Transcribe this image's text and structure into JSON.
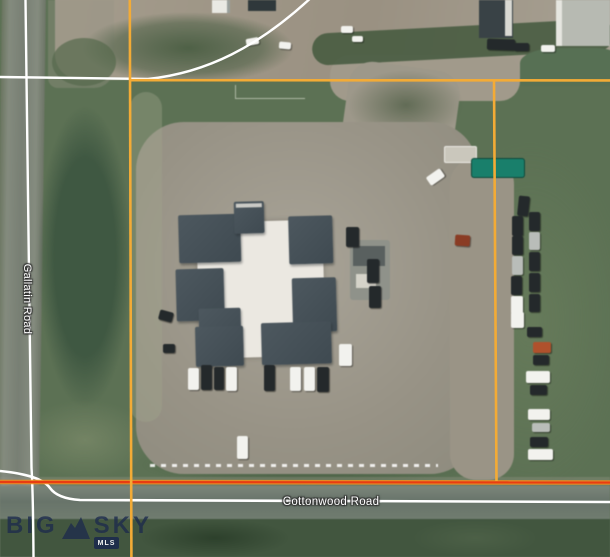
{
  "map_view": {
    "type": "satellite-aerial",
    "roads": {
      "gallatin_label": "Gallatin Road",
      "cottonwood_label": "Cottonwood Road"
    },
    "road_line_color": "#ffffff",
    "parcel_boundary": {
      "color_main": "#f3ab36",
      "color_section_line": "#e93c12",
      "color_section_glow": "#ef8c1e"
    },
    "watermark": {
      "brand_left": "BIG",
      "brand_right": "SKY",
      "badge": "MLS",
      "color": "#1d2b4d"
    },
    "terrain_colors": {
      "grass": "#5c7154",
      "grass_dark": "#41563e",
      "dirt": "#a39c8c",
      "parking": "#9b978b",
      "road": "#7e857d",
      "roof_dark": "#46525a",
      "roof_light": "#ebe8e1",
      "container_teal": "#15806b"
    },
    "vehicle_palette": {
      "dark": "#24292b",
      "white": "#f2f2ee",
      "silver": "#b9bdb9",
      "orange": "#b35029",
      "rust": "#8d3b22"
    },
    "vehicles": [
      [
        246,
        38,
        13,
        7,
        -10,
        "white"
      ],
      [
        279,
        42,
        12,
        7,
        5,
        "white"
      ],
      [
        341,
        26,
        12,
        7,
        0,
        "white"
      ],
      [
        352,
        36,
        11,
        6,
        0,
        "white"
      ],
      [
        487,
        39,
        28,
        11,
        2,
        "dark"
      ],
      [
        514,
        43,
        15,
        8,
        0,
        "dark"
      ],
      [
        541,
        45,
        14,
        7,
        0,
        "white"
      ],
      [
        427,
        172,
        17,
        10,
        -35,
        "white"
      ],
      [
        455,
        235,
        15,
        11,
        4,
        "rust"
      ],
      [
        346,
        227,
        13,
        20,
        0,
        "dark"
      ],
      [
        367,
        259,
        12,
        24,
        0,
        "dark"
      ],
      [
        369,
        286,
        12,
        22,
        0,
        "dark"
      ],
      [
        339,
        344,
        13,
        22,
        0,
        "white"
      ],
      [
        159,
        311,
        14,
        10,
        15,
        "dark"
      ],
      [
        163,
        344,
        12,
        9,
        0,
        "dark"
      ],
      [
        188,
        368,
        11,
        22,
        0,
        "white"
      ],
      [
        201,
        365,
        11,
        25,
        0,
        "dark"
      ],
      [
        214,
        367,
        10,
        23,
        0,
        "dark"
      ],
      [
        226,
        367,
        11,
        24,
        0,
        "white"
      ],
      [
        264,
        365,
        11,
        26,
        0,
        "dark"
      ],
      [
        290,
        367,
        11,
        24,
        0,
        "white"
      ],
      [
        304,
        367,
        11,
        24,
        0,
        "white"
      ],
      [
        317,
        367,
        12,
        25,
        0,
        "dark"
      ],
      [
        237,
        436,
        11,
        23,
        0,
        "white"
      ],
      [
        518,
        196,
        11,
        20,
        6,
        "dark"
      ],
      [
        512,
        216,
        11,
        20,
        0,
        "dark"
      ],
      [
        529,
        212,
        11,
        19,
        0,
        "dark"
      ],
      [
        512,
        236,
        11,
        19,
        0,
        "dark"
      ],
      [
        529,
        232,
        11,
        18,
        0,
        "silver"
      ],
      [
        512,
        256,
        11,
        19,
        0,
        "silver"
      ],
      [
        529,
        252,
        11,
        19,
        0,
        "dark"
      ],
      [
        511,
        276,
        11,
        19,
        0,
        "dark"
      ],
      [
        529,
        273,
        11,
        19,
        0,
        "dark"
      ],
      [
        511,
        296,
        12,
        18,
        0,
        "white"
      ],
      [
        529,
        294,
        11,
        18,
        0,
        "dark"
      ],
      [
        511,
        312,
        13,
        16,
        0,
        "white"
      ],
      [
        527,
        327,
        15,
        10,
        0,
        "dark"
      ],
      [
        533,
        342,
        18,
        11,
        0,
        "orange"
      ],
      [
        533,
        355,
        16,
        10,
        0,
        "dark"
      ],
      [
        526,
        371,
        24,
        12,
        0,
        "white"
      ],
      [
        530,
        385,
        17,
        10,
        0,
        "dark"
      ],
      [
        528,
        409,
        22,
        11,
        0,
        "white"
      ],
      [
        532,
        423,
        18,
        9,
        0,
        "silver"
      ],
      [
        530,
        437,
        18,
        10,
        0,
        "dark"
      ],
      [
        528,
        449,
        25,
        11,
        0,
        "white"
      ]
    ]
  }
}
